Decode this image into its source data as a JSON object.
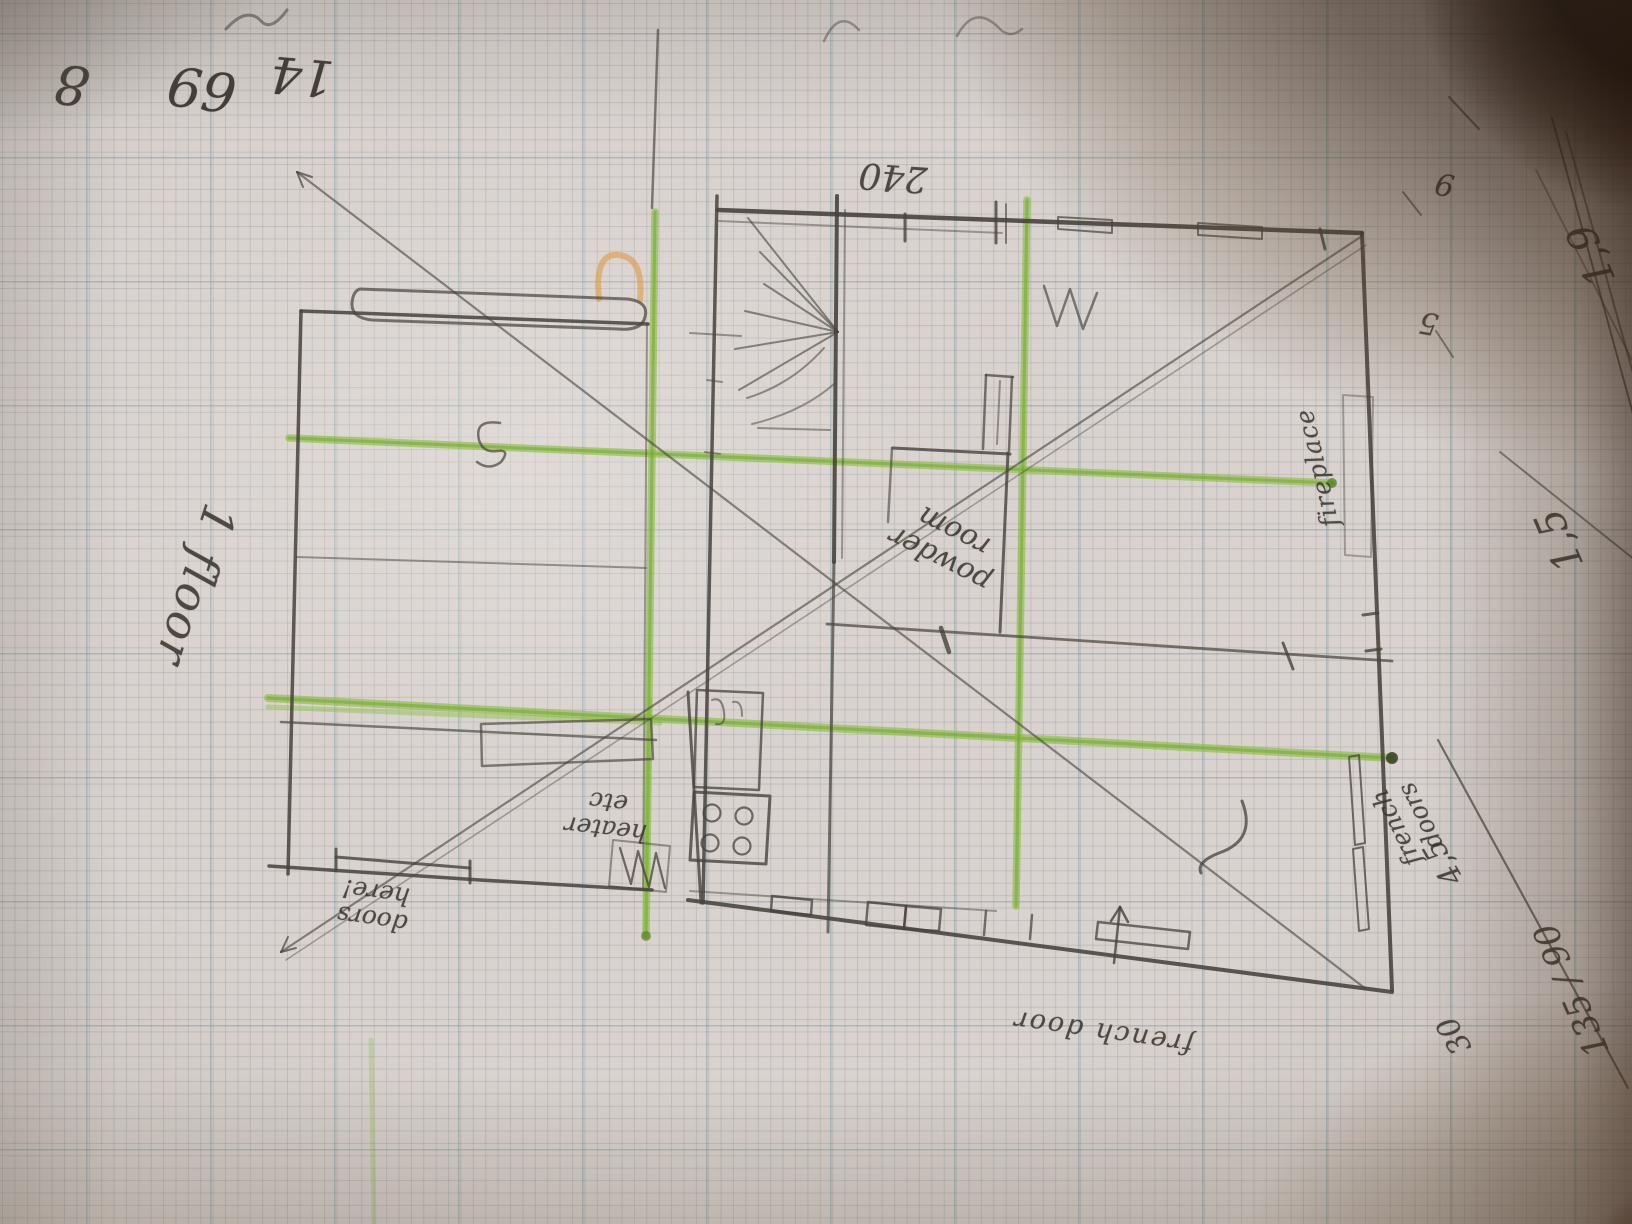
{
  "scene": {
    "description": "Photograph of a hand-drawn first-floor house plan sketched in pencil on squared graph paper, overlaid with green highlighter axis lines and crossing pencil diagonals",
    "page_orientation": "sketch written upside-down relative to the camera"
  },
  "sketch_labels": {
    "floor": "1 floor",
    "dim_240": "240",
    "powder_room": {
      "line1": "powder",
      "line2": "room"
    },
    "fireplace": "fireplace",
    "french_doors_right": {
      "line1": "french",
      "line2": "doors"
    },
    "french_door_bottom": "french door",
    "doors_here": {
      "line1": "doors",
      "line2": "here!"
    },
    "heater": {
      "line1": "heater",
      "line2": "etc"
    }
  },
  "margin_notes": {
    "num_8": "8",
    "num_69": "69",
    "num_14": "14",
    "num_9": "9",
    "num_5": "5",
    "crossed_a": "1,9",
    "crossed_b": "1,5",
    "dim_45": "4,5",
    "dim_30": "30",
    "ratio": "135 / 90"
  },
  "colors": {
    "paper": "#d9d2ce",
    "grid_minor": "#808a90",
    "grid_major": "#688e98",
    "pencil": "#47423c",
    "highlighter_green": "#84bc3a",
    "highlighter_orange": "#dd9a44",
    "table_shadow": "#2e1a0c"
  }
}
